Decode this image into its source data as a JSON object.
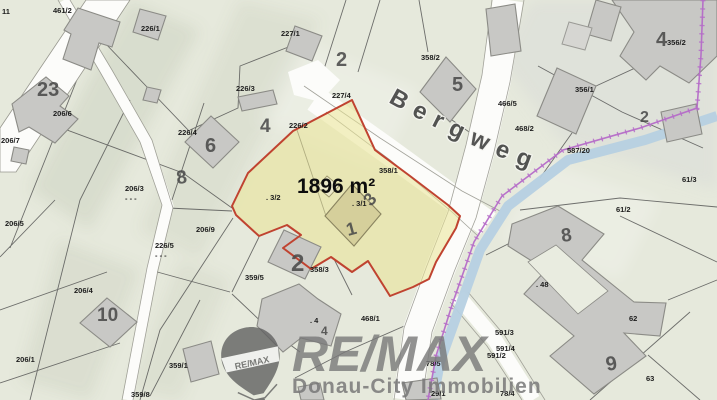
{
  "map": {
    "street_label": "Bergweg",
    "area_label": "1896 m²",
    "watermark": {
      "brand": "RE/MAX",
      "subtitle": "Donau-City Immobilien",
      "balloon_label": "RE/MAX"
    },
    "colors": {
      "background": "#e6e9dc",
      "highlight_fill": "#eae394",
      "highlight_border": "#c04330",
      "stream": "#b6d0e2",
      "boundary": "#b56cc8",
      "road": "#fcfcfa",
      "building": "#c8c8c5",
      "label": "#1c1c1c",
      "house_number": "#4a4a4a",
      "watermark_gray": "#787878"
    },
    "parcel_labels": [
      {
        "text": "11",
        "x": 2,
        "y": 14
      },
      {
        "text": "461/2",
        "x": 53,
        "y": 13
      },
      {
        "text": "226/1",
        "x": 141,
        "y": 31
      },
      {
        "text": "227/1",
        "x": 281,
        "y": 36
      },
      {
        "text": "358/2",
        "x": 421,
        "y": 60
      },
      {
        "text": "356/2",
        "x": 667,
        "y": 45
      },
      {
        "text": "226/3",
        "x": 236,
        "y": 91
      },
      {
        "text": "466/5",
        "x": 498,
        "y": 106
      },
      {
        "text": "468/2",
        "x": 515,
        "y": 131
      },
      {
        "text": "356/1",
        "x": 575,
        "y": 92
      },
      {
        "text": "226/4",
        "x": 178,
        "y": 135
      },
      {
        "text": "226/2",
        "x": 289,
        "y": 128
      },
      {
        "text": "227/4",
        "x": 332,
        "y": 98
      },
      {
        "text": "358/1",
        "x": 379,
        "y": 173
      },
      {
        "text": "587/20",
        "x": 567,
        "y": 153
      },
      {
        "text": "61/3",
        "x": 682,
        "y": 182
      },
      {
        "text": "206/6",
        "x": 53,
        "y": 116
      },
      {
        "text": "206/7",
        "x": 1,
        "y": 143
      },
      {
        "text": "206/5",
        "x": 5,
        "y": 226
      },
      {
        "text": "206/9",
        "x": 196,
        "y": 232
      },
      {
        "text": "226/5",
        "x": 155,
        "y": 248
      },
      {
        "text": "- - -",
        "x": 155,
        "y": 258
      },
      {
        "text": "206/3",
        "x": 125,
        "y": 191
      },
      {
        "text": "- - -",
        "x": 125,
        "y": 201
      },
      {
        "text": "206/4",
        "x": 74,
        "y": 293
      },
      {
        "text": "206/1",
        "x": 16,
        "y": 362
      },
      {
        "text": "359/1",
        "x": 169,
        "y": 368
      },
      {
        "text": "359/8",
        "x": 131,
        "y": 397
      },
      {
        "text": "359/5",
        "x": 245,
        "y": 280
      },
      {
        "text": "358/3",
        "x": 310,
        "y": 272
      },
      {
        "text": ". 3/2",
        "x": 266,
        "y": 200
      },
      {
        "text": ". 3/1",
        "x": 352,
        "y": 206
      },
      {
        "text": ". 4",
        "x": 310,
        "y": 323
      },
      {
        "text": ". 48",
        "x": 536,
        "y": 287
      },
      {
        "text": "468/1",
        "x": 361,
        "y": 321
      },
      {
        "text": "78/5",
        "x": 426,
        "y": 366
      },
      {
        "text": "29/1",
        "x": 431,
        "y": 396
      },
      {
        "text": "61/2",
        "x": 616,
        "y": 212
      },
      {
        "text": "62",
        "x": 629,
        "y": 321
      },
      {
        "text": "63",
        "x": 646,
        "y": 381
      },
      {
        "text": "591/3",
        "x": 495,
        "y": 335
      },
      {
        "text": "591/4",
        "x": 496,
        "y": 351
      },
      {
        "text": "591/2",
        "x": 487,
        "y": 358
      },
      {
        "text": "78/4",
        "x": 500,
        "y": 396
      }
    ],
    "house_numbers": [
      {
        "text": "23",
        "x": 37,
        "y": 96,
        "size": 20,
        "rot": 0
      },
      {
        "text": "8",
        "x": 177,
        "y": 184,
        "size": 19,
        "rot": -6
      },
      {
        "text": "6",
        "x": 205,
        "y": 152,
        "size": 20,
        "rot": 0
      },
      {
        "text": "4",
        "x": 260,
        "y": 132,
        "size": 19,
        "rot": 0
      },
      {
        "text": "2",
        "x": 336,
        "y": 66,
        "size": 20,
        "rot": 0
      },
      {
        "text": "5",
        "x": 452,
        "y": 91,
        "size": 20,
        "rot": 0
      },
      {
        "text": "4",
        "x": 656,
        "y": 46,
        "size": 20,
        "rot": 0
      },
      {
        "text": "2",
        "x": 640,
        "y": 122,
        "size": 16,
        "rot": 0
      },
      {
        "text": "10",
        "x": 97,
        "y": 321,
        "size": 19,
        "rot": 0
      },
      {
        "text": "2",
        "x": 291,
        "y": 271,
        "size": 24,
        "rot": 0
      },
      {
        "text": "8",
        "x": 562,
        "y": 242,
        "size": 19,
        "rot": -8
      },
      {
        "text": "9",
        "x": 607,
        "y": 371,
        "size": 20,
        "rot": -10
      },
      {
        "text": "4",
        "x": 321,
        "y": 335,
        "size": 12,
        "rot": 0
      },
      {
        "text": "3",
        "x": 371,
        "y": 207,
        "size": 18,
        "rot": -48,
        "fill": "#615e46"
      },
      {
        "text": "1",
        "x": 348,
        "y": 236,
        "size": 18,
        "rot": -15,
        "fill": "#615e46"
      }
    ]
  }
}
